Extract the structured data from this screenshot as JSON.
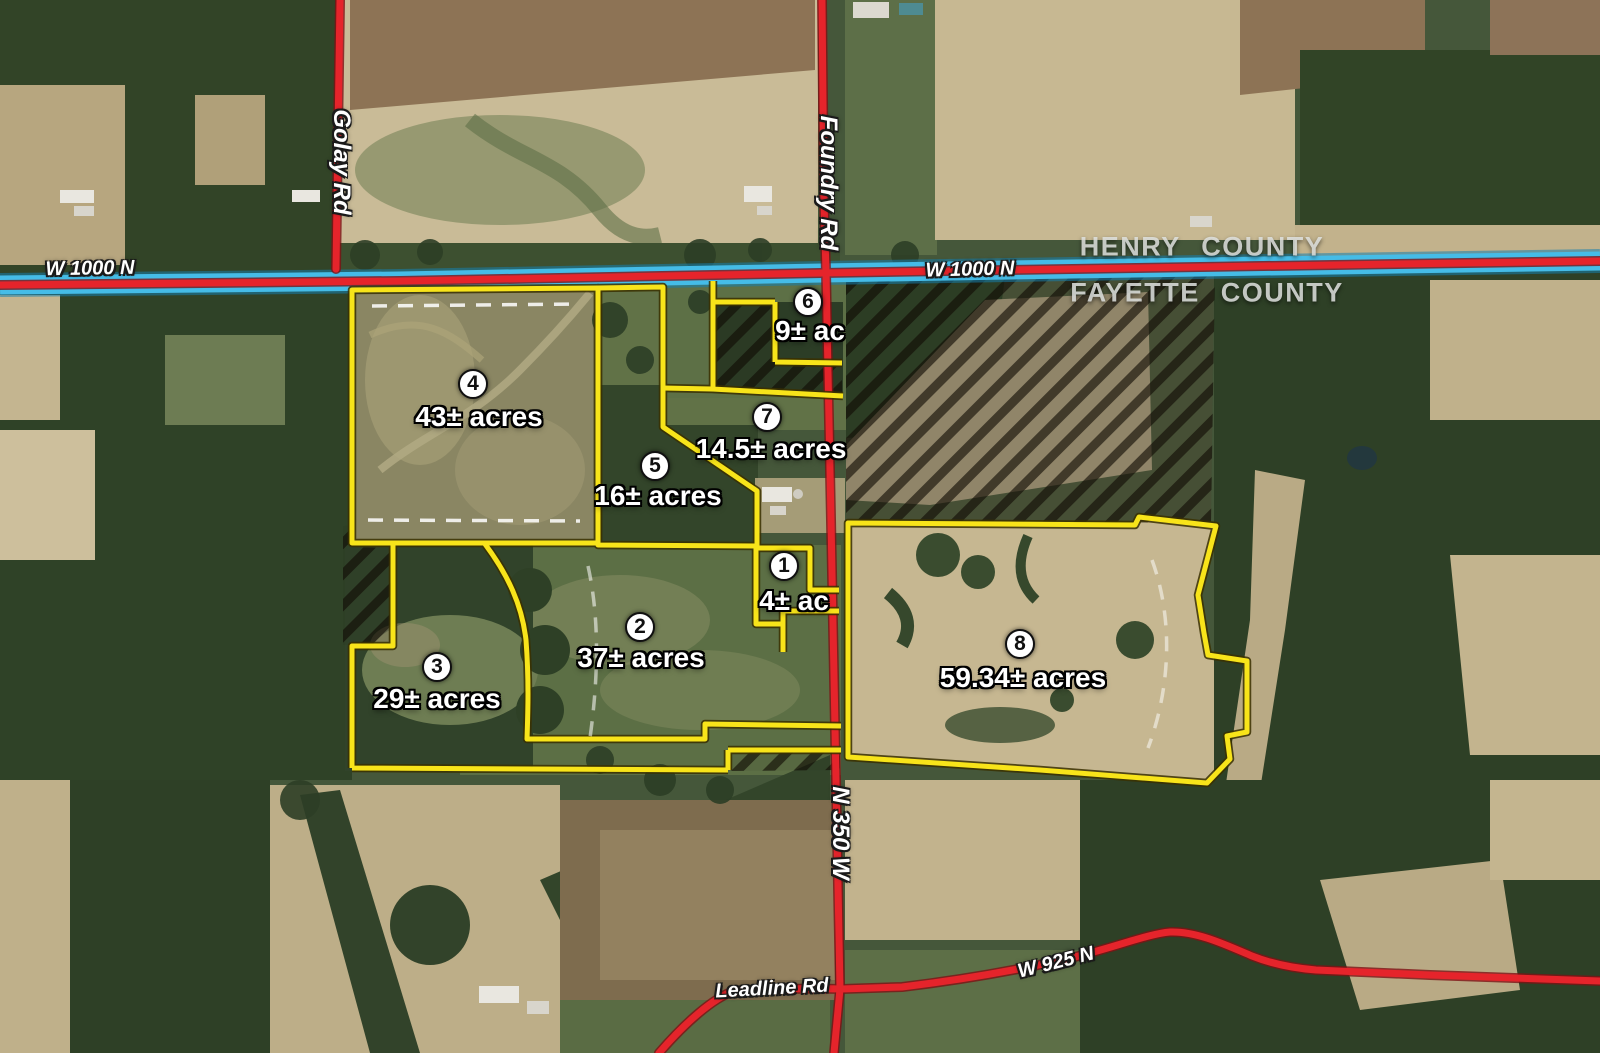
{
  "counties": {
    "north": "HENRY COUNTY",
    "south": "FAYETTE COUNTY"
  },
  "roads": {
    "golay": {
      "label": "Golay Rd"
    },
    "foundry": {
      "label": "Foundry Rd"
    },
    "w1000n": {
      "label": "W 1000 N"
    },
    "n350w": {
      "label": "N 350 W"
    },
    "leadline": {
      "label": "Leadline Rd"
    },
    "w925n": {
      "label": "W 925 N"
    }
  },
  "tracts": [
    {
      "number": "1",
      "acreage": "4± ac"
    },
    {
      "number": "2",
      "acreage": "37± acres"
    },
    {
      "number": "3",
      "acreage": "29± acres"
    },
    {
      "number": "4",
      "acreage": "43± acres"
    },
    {
      "number": "5",
      "acreage": "16± acres"
    },
    {
      "number": "6",
      "acreage": "9± ac"
    },
    {
      "number": "7",
      "acreage": "14.5± acres"
    },
    {
      "number": "8",
      "acreage": "59.34± acres"
    }
  ],
  "map_colors": {
    "parcel_boundary": "#f8e41a",
    "road": "#e5242b",
    "county_line": "#45bce7",
    "excluded_hatch_stripe": "#140d06"
  }
}
